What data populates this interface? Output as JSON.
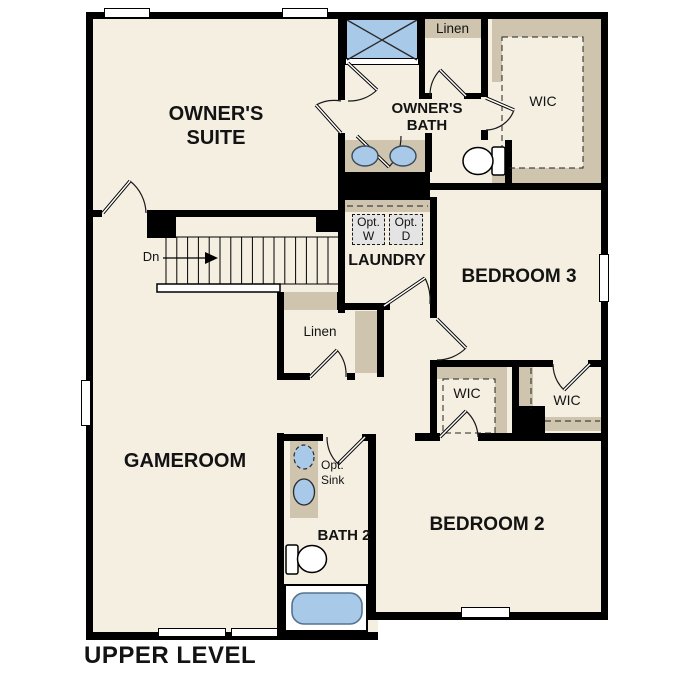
{
  "plan_title": "UPPER LEVEL",
  "rooms": {
    "owners_suite": "OWNER'S SUITE",
    "owners_bath": "OWNER'S BATH",
    "owners_wic": "WIC",
    "linen_upper": "Linen",
    "laundry": "LAUNDRY",
    "bedroom3": "BEDROOM 3",
    "linen_hall": "Linen",
    "wic_bedroom2": "WIC",
    "wic_bedroom3": "WIC",
    "gameroom": "GAMEROOM",
    "bath2": "BATH 2",
    "bedroom2": "BEDROOM 2"
  },
  "annotations": {
    "stair_direction": "Dn",
    "optional_washer": "Opt. W",
    "optional_dryer": "Opt. D",
    "optional_sink": "Opt. Sink"
  },
  "legend_colors": {
    "floor": "#f5efe2",
    "cabinet_tan": "#cfc4ae",
    "plumbing_blue": "#a9c9e9",
    "wall_black": "#000000",
    "optional_appliance_gray": "#e4e4e4"
  }
}
